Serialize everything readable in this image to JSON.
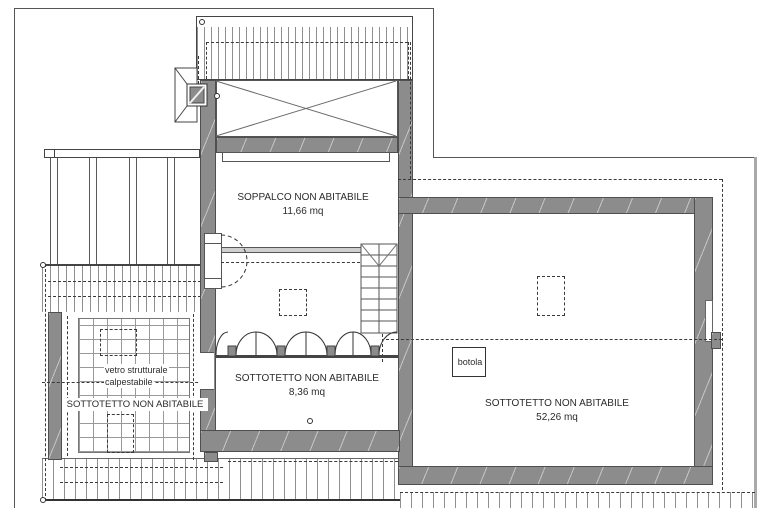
{
  "drawing": {
    "kind": "architectural attic floor plan",
    "colors": {
      "background": "#ffffff",
      "line": "#2b2b2b",
      "dash": "#3a3a3a",
      "wall_fill": "#8c8c8c",
      "wall_edge": "#4f4f4f",
      "hatch": "#8f8f8f",
      "grid": "#9a9a9a",
      "band_fill": "#cfcfcf"
    },
    "rooms": {
      "soppalco": {
        "label": "SOPPALCO NON ABITABILE",
        "area": "11,66 mq"
      },
      "sottotetto_center": {
        "label": "SOTTOTETTO NON ABITABILE",
        "area": "8,36 mq"
      },
      "sottotetto_right": {
        "label": "SOTTOTETTO NON ABITABILE",
        "area": "52,26 mq"
      },
      "sottotetto_left": {
        "label": "SOTTOTETTO NON ABITABILE"
      }
    },
    "annotations": {
      "glass_floor": [
        "vetro strutturale",
        "calpestabile"
      ],
      "hatch_door": "botola"
    }
  }
}
